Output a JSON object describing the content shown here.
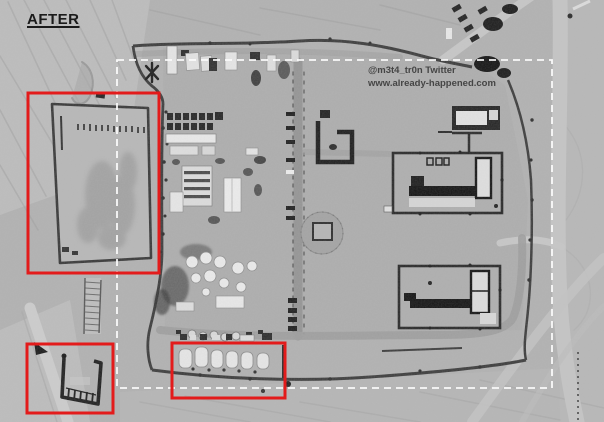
{
  "meta": {
    "width": 604,
    "height": 422
  },
  "labels": {
    "after": "AFTER"
  },
  "watermark": {
    "line1": "@m3t4_tr0n Twitter",
    "line2": "www.already-happened.com"
  },
  "colors": {
    "annotation_red": "#e31b1b",
    "dashed_outline": "#fdfdfd",
    "after_label": "#1b1b1b",
    "watermark_text": "#454545",
    "desert_base": "#b1b1b1"
  },
  "annotations": {
    "dashed_box": {
      "x": 117,
      "y": 60,
      "w": 435,
      "h": 328
    },
    "red_boxes": [
      {
        "id": "graded-field-highlight",
        "x": 28,
        "y": 93,
        "w": 131,
        "h": 180
      },
      {
        "id": "revetment-highlight",
        "x": 27,
        "y": 344,
        "w": 86,
        "h": 69
      },
      {
        "id": "tent-row-highlight",
        "x": 172,
        "y": 343,
        "w": 113,
        "h": 55
      }
    ]
  }
}
